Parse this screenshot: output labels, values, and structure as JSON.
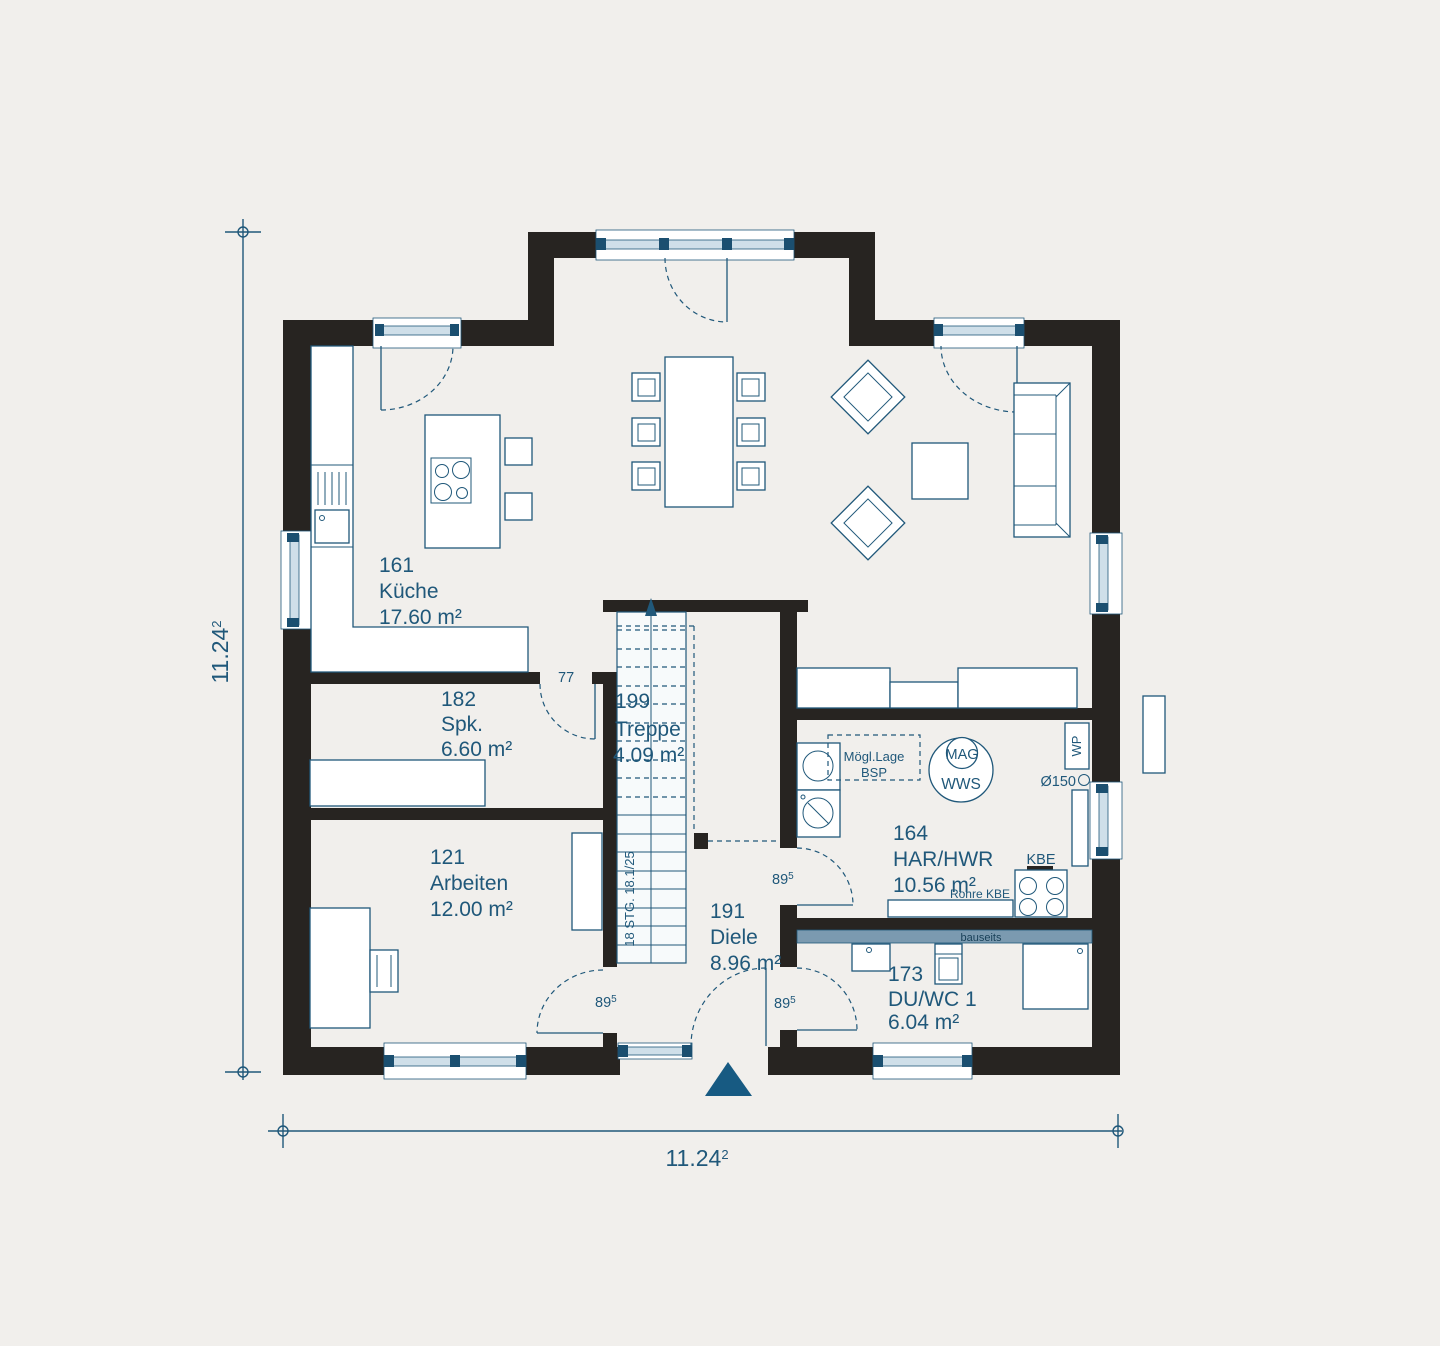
{
  "drawing": {
    "type": "floor-plan",
    "floor_outline_present": true
  },
  "rooms": {
    "kueche": {
      "id": "161",
      "name": "Küche",
      "area": "17.60 m²"
    },
    "spk": {
      "id": "182",
      "name": "Spk.",
      "area": "6.60 m²"
    },
    "arbeiten": {
      "id": "121",
      "name": "Arbeiten",
      "area": "12.00 m²"
    },
    "treppe": {
      "id": "199",
      "name": "Treppe",
      "area": "4.09 m²"
    },
    "diele": {
      "id": "191",
      "name": "Diele",
      "area": "8.96 m²"
    },
    "har": {
      "id": "164",
      "name": "HAR/HWR",
      "area": "10.56 m²"
    },
    "duwc": {
      "id": "173",
      "name": "DU/WC 1",
      "area": "6.04 m²"
    }
  },
  "annotations": {
    "stair_note": "18 STG. 18.1/25",
    "kitchen_door_width": "77",
    "door_width": {
      "num": "89",
      "sup": "5"
    },
    "bsp": {
      "line1": "Mögl.Lage",
      "line2": "BSP"
    },
    "mag": "MAG",
    "wws": "WWS",
    "wp": "WP",
    "pipe_diameter": "Ø150",
    "kbe": "KBE",
    "rohre_kbe": "Rohre KBE",
    "bauseits": "bauseits"
  },
  "dimensions": {
    "width": {
      "num": "11.24",
      "sup": "2"
    },
    "height": {
      "num": "11.24",
      "sup": "2"
    }
  },
  "colors": {
    "background": "#f1efec",
    "wall": "#272421",
    "ink": "#20587a",
    "window_fill": "#cfdfe9",
    "window_accent": "#1b4f70",
    "band": "#7b9ab0",
    "stair_fill": "#f7fafb",
    "arrow": "#175a82",
    "text_dark": "#173f57"
  }
}
